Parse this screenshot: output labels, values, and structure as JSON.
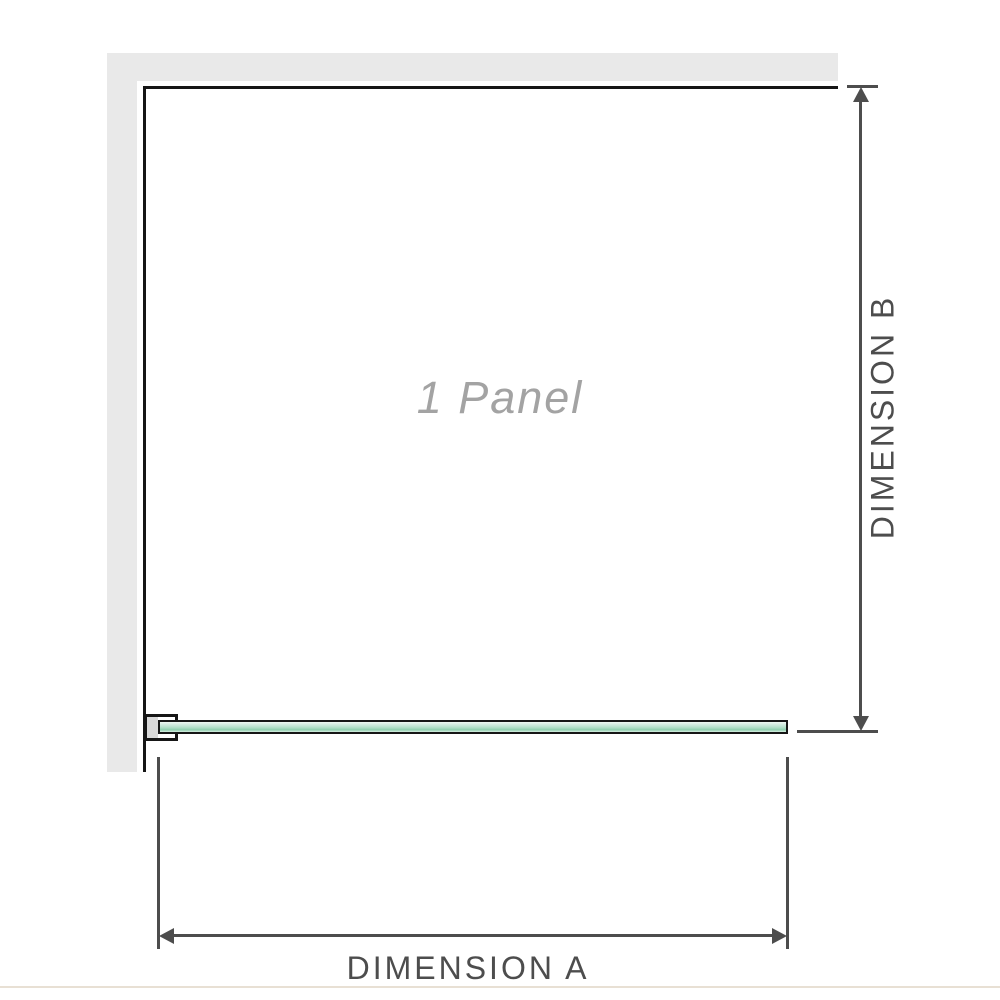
{
  "diagram": {
    "panel_label": "1 Panel",
    "dimension_a_label": "DIMENSION A",
    "dimension_b_label": "DIMENSION B"
  },
  "colors": {
    "wall": "#e9e9e9",
    "outline": "#161616",
    "glass_dark": "#8fcfae",
    "dim": "#4d4d4d",
    "watermark": "#a3a3a3",
    "footer": "#e8e0d4"
  }
}
